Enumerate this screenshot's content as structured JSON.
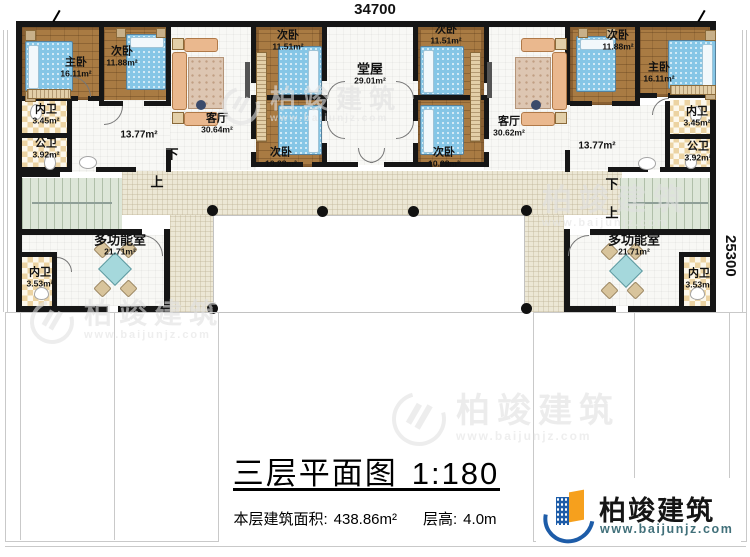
{
  "dimensions": {
    "top": "34700",
    "right": "25300"
  },
  "stairs": {
    "down": "下",
    "up": "上"
  },
  "rooms": [
    {
      "name": "主卧",
      "area": "16.11m²"
    },
    {
      "name": "次卧",
      "area": "11.88m²"
    },
    {
      "name": "内卫",
      "area": "3.45m²"
    },
    {
      "name": "公卫",
      "area": "3.92m²"
    },
    {
      "name": "客厅",
      "area": "30.64m²"
    },
    {
      "name": "",
      "area": "13.77m²"
    },
    {
      "name": "次卧",
      "area": "11.51m²"
    },
    {
      "name": "次卧",
      "area": "10.28m²"
    },
    {
      "name": "堂屋",
      "area": "29.01m²"
    },
    {
      "name": "次卧",
      "area": "11.51m²"
    },
    {
      "name": "次卧",
      "area": "10.28m²"
    },
    {
      "name": "客厅",
      "area": "30.62m²"
    },
    {
      "name": "次卧",
      "area": "11.88m²"
    },
    {
      "name": "主卧",
      "area": "16.11m²"
    },
    {
      "name": "内卫",
      "area": "3.45m²"
    },
    {
      "name": "公卫",
      "area": "3.92m²"
    },
    {
      "name": "",
      "area": "13.77m²"
    },
    {
      "name": "多功能室",
      "area": "21.71m²"
    },
    {
      "name": "内卫",
      "area": "3.53m²"
    },
    {
      "name": "多功能室",
      "area": "21.71m²"
    },
    {
      "name": "内卫",
      "area": "3.53m²"
    }
  ],
  "title": {
    "text": "三层平面图",
    "scale": "1:180"
  },
  "info": {
    "area_label": "本层建筑面积:",
    "area_value": "438.86m²",
    "height_label": "层高:",
    "height_value": "4.0m"
  },
  "brand": {
    "name": "柏竣建筑",
    "url": "www.baijunjz.com"
  },
  "colors": {
    "wall": "#161616",
    "wood": "#a97b43",
    "bed": "#85c6e6",
    "tile": "#ecd3a2",
    "terrace": "#ece7d5",
    "stair": "#dde6d8",
    "brand_blue": "#1d5ca8",
    "brand_orange": "#f6a01d"
  }
}
